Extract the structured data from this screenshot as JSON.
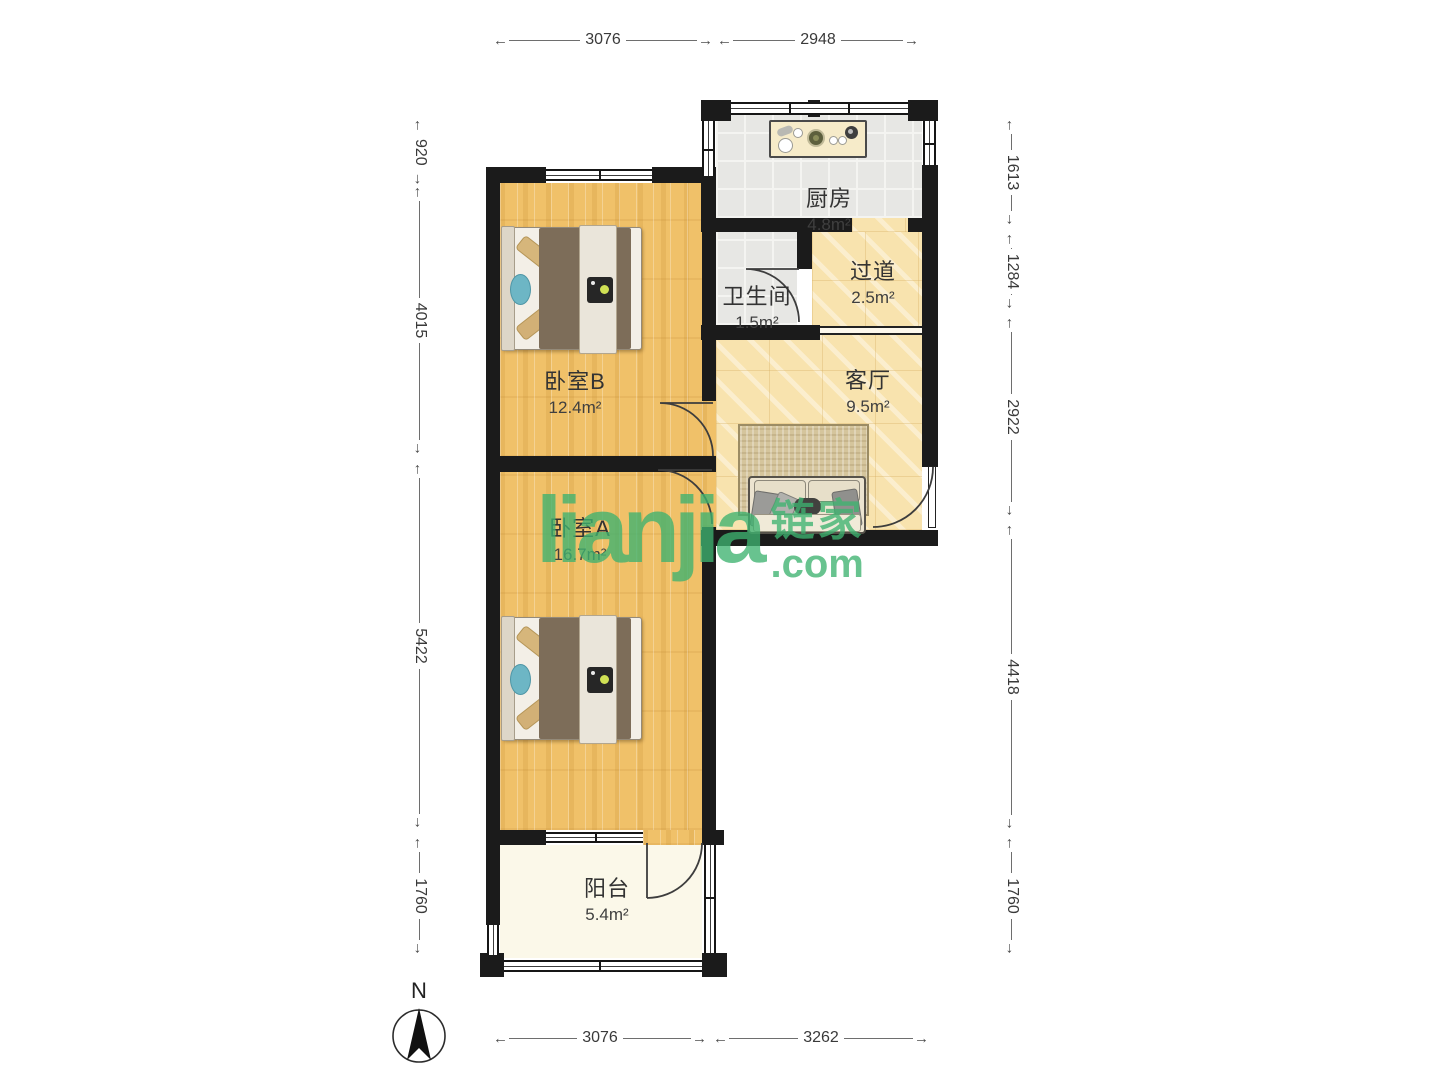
{
  "rooms": {
    "kitchen": {
      "name": "厨房",
      "area": "4.8m²"
    },
    "hallway": {
      "name": "过道",
      "area": "2.5m²"
    },
    "bathroom": {
      "name": "卫生间",
      "area": "1.5m²"
    },
    "living": {
      "name": "客厅",
      "area": "9.5m²"
    },
    "bedroom_b": {
      "name": "卧室B",
      "area": "12.4m²"
    },
    "bedroom_a": {
      "name": "卧室A",
      "area": "16.7m²"
    },
    "balcony": {
      "name": "阳台",
      "area": "5.4m²"
    }
  },
  "dimensions_mm": {
    "top": [
      "3076",
      "2948"
    ],
    "bottom": [
      "3076",
      "3262"
    ],
    "left": [
      "920",
      "4015",
      "5422",
      "1760"
    ],
    "right": [
      "1613",
      "1284",
      "2922",
      "4418",
      "1760"
    ]
  },
  "compass": {
    "north_label": "N"
  },
  "watermark": {
    "brand": "lianjia",
    "brand_cn": "链家",
    "suffix": ".com"
  },
  "palette": {
    "wall": "#1b1b1b",
    "wood_floor": "#f0c169",
    "stone_floor": "#f8e3ae",
    "tile_floor": "#e7e7e4",
    "balcony_floor": "#fbf8e9",
    "watermark_green": "#41b273"
  }
}
